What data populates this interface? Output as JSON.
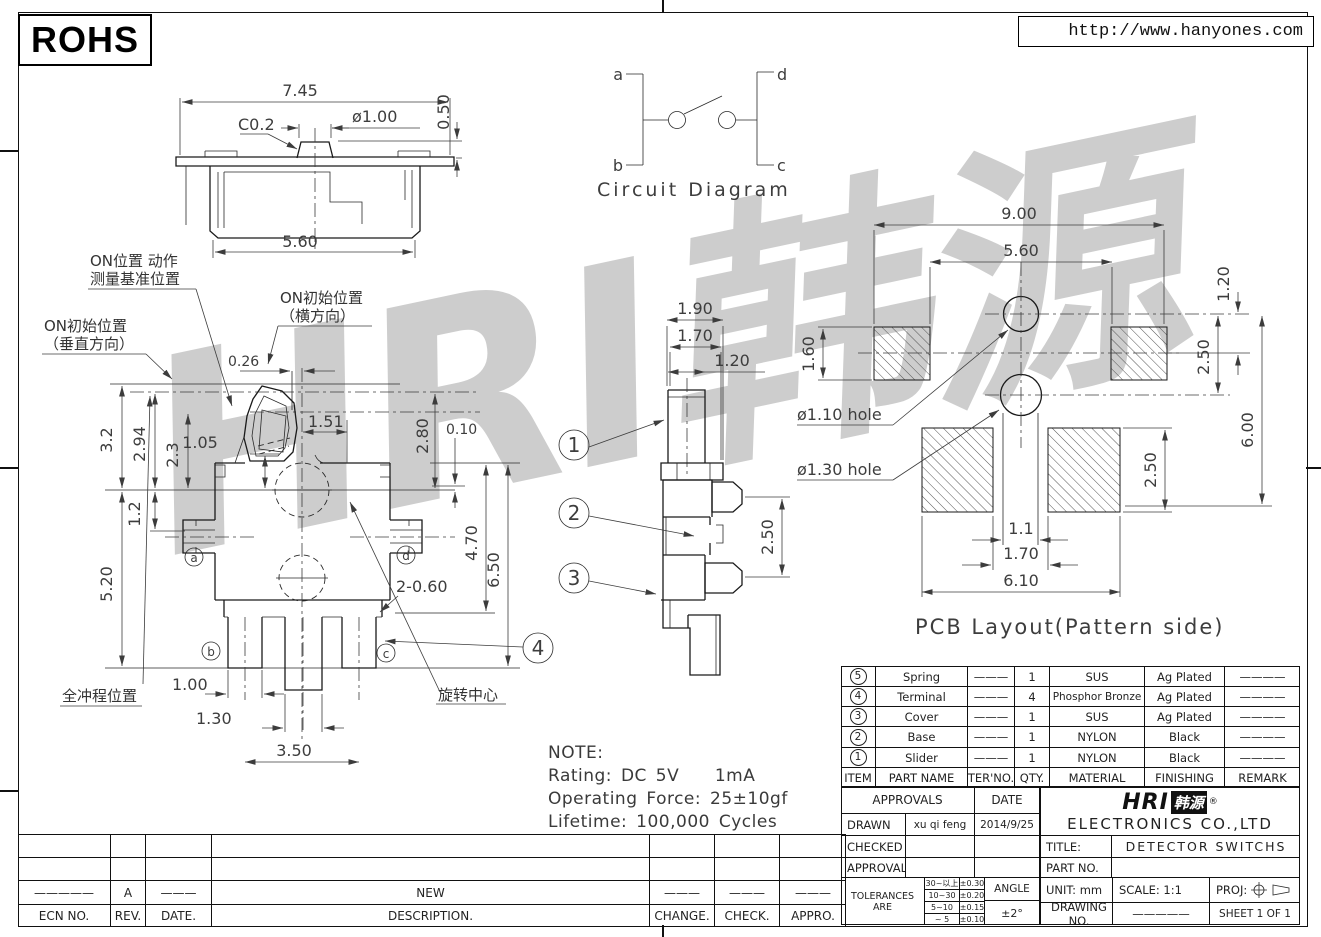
{
  "header": {
    "rohs": "ROHS",
    "url": "http://www.hanyones.com"
  },
  "watermark": "HRI韩源",
  "circuit": {
    "title": "Circuit Diagram",
    "t_a": "a",
    "t_b": "b",
    "t_c": "c",
    "t_d": "d"
  },
  "top_view": {
    "w": "7.45",
    "chamfer": "C0.2",
    "dia": "ø1.00",
    "h": "0.50",
    "base_w": "5.60"
  },
  "front_view": {
    "d026": "0.26",
    "d151": "1.51",
    "d280": "2.80",
    "d010": "0.10",
    "d105": "1.05",
    "d32": "3.2",
    "d294": "2.94",
    "d23": "2.3",
    "d12": "1.2",
    "d520": "5.20",
    "d470": "4.70",
    "d650": "6.50",
    "d2060": "2-0.60",
    "d100": "1.00",
    "d130": "1.30",
    "d350": "3.50",
    "la": "a",
    "lb": "b",
    "lc": "c",
    "ld": "d",
    "c4": "4",
    "ann_on_pos_1": "ON位置 动作",
    "ann_on_pos_2": "测量基准位置",
    "ann_on_init_v1": "ON初始位置",
    "ann_on_init_v2": "（垂直方向）",
    "ann_on_init_h1": "ON初始位置",
    "ann_on_init_h2": "（横方向）",
    "ann_full_stroke": "全冲程位置",
    "ann_rotation": "旋转中心"
  },
  "side_view": {
    "d190": "1.90",
    "d170": "1.70",
    "d120": "1.20",
    "d250": "2.50",
    "c1": "1",
    "c2": "2",
    "c3": "3"
  },
  "pcb": {
    "title": "PCB Layout(Pattern side)",
    "d900": "9.00",
    "d560": "5.60",
    "d160": "1.60",
    "d120": "1.20",
    "d250t": "2.50",
    "d600": "6.00",
    "d250b": "2.50",
    "d11": "1.1",
    "d170": "1.70",
    "d610": "6.10",
    "hole_small": "ø1.10 hole",
    "hole_large": "ø1.30 hole"
  },
  "note": {
    "title": "NOTE:",
    "line1": "Rating: DC 5V    1mA",
    "line2": "Operating Force: 25±10gf",
    "line3": "Lifetime: 100,000 Cycles"
  },
  "parts": {
    "headers": [
      "ITEM",
      "PART NAME",
      "TER'NO.",
      "QTY.",
      "MATERIAL",
      "FINISHING",
      "REMARK"
    ],
    "rows": [
      {
        "item": "5",
        "name": "Spring",
        "ter": "———",
        "qty": "1",
        "material": "SUS",
        "finishing": "Ag Plated",
        "remark": "————"
      },
      {
        "item": "4",
        "name": "Terminal",
        "ter": "———",
        "qty": "4",
        "material": "Phosphor Bronze",
        "finishing": "Ag Plated",
        "remark": "————"
      },
      {
        "item": "3",
        "name": "Cover",
        "ter": "———",
        "qty": "1",
        "material": "SUS",
        "finishing": "Ag Plated",
        "remark": "————"
      },
      {
        "item": "2",
        "name": "Base",
        "ter": "———",
        "qty": "1",
        "material": "NYLON",
        "finishing": "Black",
        "remark": "————"
      },
      {
        "item": "1",
        "name": "Slider",
        "ter": "———",
        "qty": "1",
        "material": "NYLON",
        "finishing": "Black",
        "remark": "————"
      }
    ]
  },
  "title_block": {
    "approvals_label": "APPROVALS",
    "date_label": "DATE",
    "drawn_label": "DRAWN",
    "drawn_by": "xu qi feng",
    "drawn_date": "2014/9/25",
    "checked_label": "CHECKED",
    "approvals2_label": "APPROVALS",
    "tolerances_label": "TOLERANCES ARE",
    "tol_rows": [
      {
        "range": "30~以上",
        "tol": "±0.30"
      },
      {
        "range": "10~30",
        "tol": "±0.20"
      },
      {
        "range": "5~10",
        "tol": "±0.15"
      },
      {
        "range": "~ 5",
        "tol": "±0.10"
      }
    ],
    "angle_label": "ANGLE",
    "angle_tol": "±2°",
    "company_logo": "HRI",
    "company_logo_cn": "韩源",
    "company_reg": "®",
    "company_name": "ELECTRONICS CO.,LTD",
    "title_label": "TITLE:",
    "title_value": "DETECTOR SWITCHS",
    "part_no_label": "PART NO.",
    "unit_label": "UNIT: mm",
    "scale_label": "SCALE: 1:1",
    "proj_label": "PROJ:",
    "drawing_no_label": "DRAWING NO.",
    "drawing_no_value": "—————",
    "sheet_label": "SHEET 1 OF 1"
  },
  "revision": {
    "headers": [
      "ECN NO.",
      "REV.",
      "DATE.",
      "DESCRIPTION.",
      "CHANGE.",
      "CHECK.",
      "APPRO."
    ],
    "row": {
      "ecn": "—————",
      "rev": "A",
      "date": "———",
      "description": "NEW",
      "change": "———",
      "check": "———",
      "appro": "———"
    }
  }
}
